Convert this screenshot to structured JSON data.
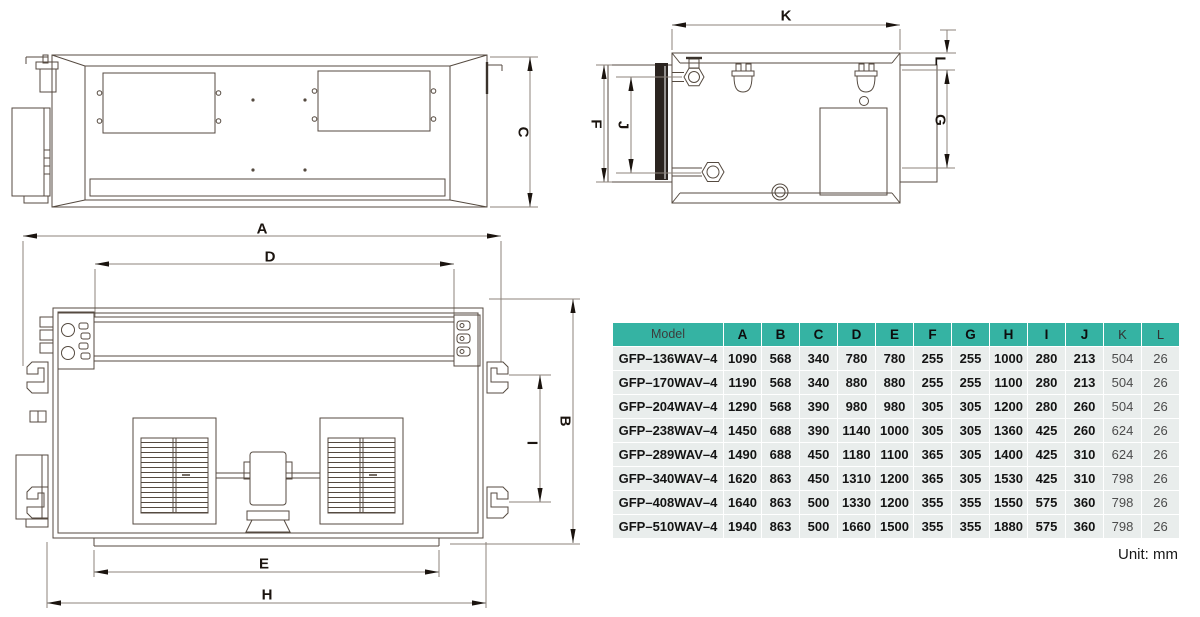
{
  "page": {
    "unit_note": "Unit: mm"
  },
  "colors": {
    "table_header_bg": "#35b3a3",
    "table_row_bg": "#e9edec",
    "drawing_line": "#554a40",
    "dimension_line": "#8c837b",
    "arrow_fill": "#1b140f"
  },
  "drawings": {
    "front_view": {
      "dims": {
        "c": "C"
      }
    },
    "side_view": {
      "dims": {
        "k": "K",
        "l": "L",
        "f": "F",
        "j": "J",
        "g": "G"
      }
    },
    "plan_view": {
      "dims": {
        "a": "A",
        "d": "D",
        "b": "B",
        "i": "I",
        "e": "E",
        "h": "H"
      }
    }
  },
  "table": {
    "headers": [
      "Model",
      "A",
      "B",
      "C",
      "D",
      "E",
      "F",
      "G",
      "H",
      "I",
      "J",
      "K",
      "L"
    ],
    "muted_columns": [
      "K",
      "L"
    ],
    "rows": [
      {
        "model": "GFP–136WAV–4",
        "values": [
          "1090",
          "568",
          "340",
          "780",
          "780",
          "255",
          "255",
          "1000",
          "280",
          "213",
          "504",
          "26"
        ]
      },
      {
        "model": "GFP–170WAV–4",
        "values": [
          "1190",
          "568",
          "340",
          "880",
          "880",
          "255",
          "255",
          "1100",
          "280",
          "213",
          "504",
          "26"
        ]
      },
      {
        "model": "GFP–204WAV–4",
        "values": [
          "1290",
          "568",
          "390",
          "980",
          "980",
          "305",
          "305",
          "1200",
          "280",
          "260",
          "504",
          "26"
        ]
      },
      {
        "model": "GFP–238WAV–4",
        "values": [
          "1450",
          "688",
          "390",
          "1140",
          "1000",
          "305",
          "305",
          "1360",
          "425",
          "260",
          "624",
          "26"
        ]
      },
      {
        "model": "GFP–289WAV–4",
        "values": [
          "1490",
          "688",
          "450",
          "1180",
          "1100",
          "365",
          "305",
          "1400",
          "425",
          "310",
          "624",
          "26"
        ]
      },
      {
        "model": "GFP–340WAV–4",
        "values": [
          "1620",
          "863",
          "450",
          "1310",
          "1200",
          "365",
          "305",
          "1530",
          "425",
          "310",
          "798",
          "26"
        ]
      },
      {
        "model": "GFP–408WAV–4",
        "values": [
          "1640",
          "863",
          "500",
          "1330",
          "1200",
          "355",
          "355",
          "1550",
          "575",
          "360",
          "798",
          "26"
        ]
      },
      {
        "model": "GFP–510WAV–4",
        "values": [
          "1940",
          "863",
          "500",
          "1660",
          "1500",
          "355",
          "355",
          "1880",
          "575",
          "360",
          "798",
          "26"
        ]
      }
    ]
  }
}
